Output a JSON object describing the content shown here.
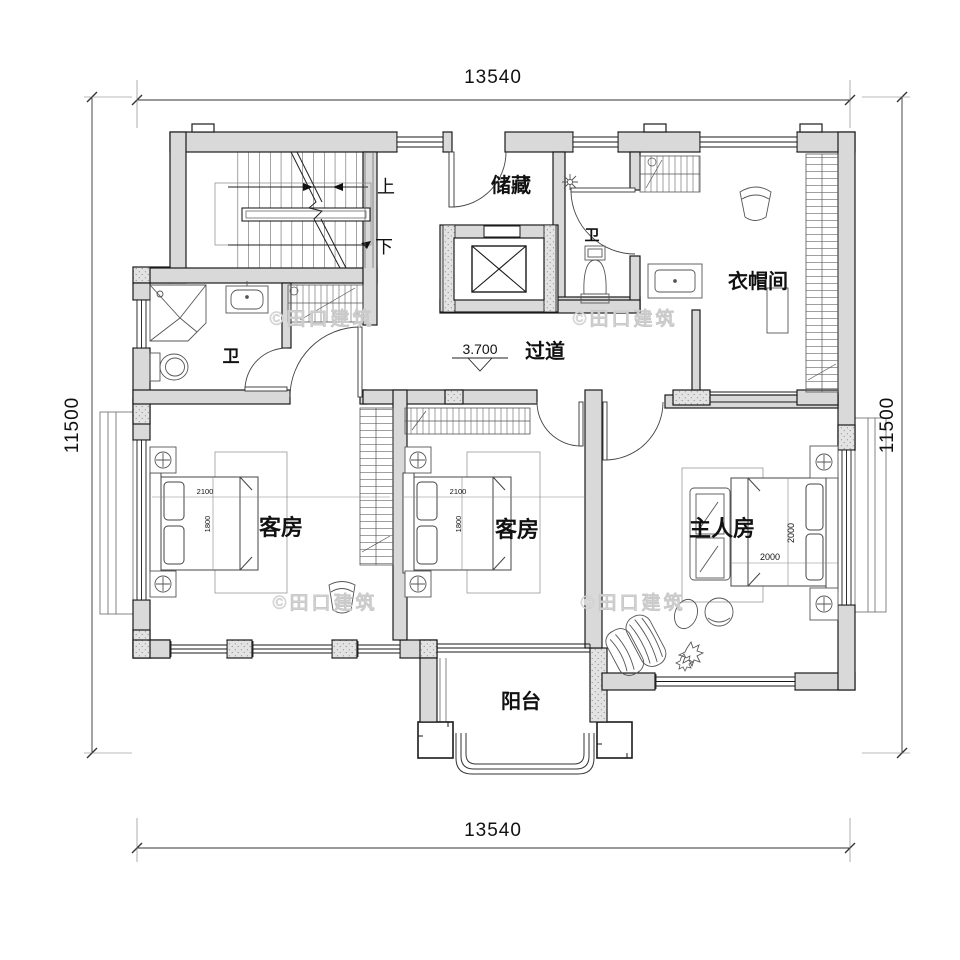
{
  "plan": {
    "dims": {
      "top": "13540",
      "bottom": "13540",
      "left": "11500",
      "right": "11500"
    },
    "rooms": {
      "storage": "储藏",
      "bath_top": "卫",
      "closet": "衣帽间",
      "corridor": "过道",
      "bath_left": "卫",
      "guest_left": "客房",
      "guest_mid": "客房",
      "master": "主人房",
      "balcony": "阳台"
    },
    "stairs": {
      "up": "上",
      "down": "下"
    },
    "elevation": "3.700",
    "beds": {
      "guest_w": "2100",
      "guest_d": "1800",
      "master_w": "2000",
      "master_d": "2000"
    },
    "watermark": "©田口建筑",
    "colors": {
      "wall_fill": "#d9d9d9",
      "line": "#1a1a1a",
      "watermark": "#dcdcdc"
    }
  }
}
